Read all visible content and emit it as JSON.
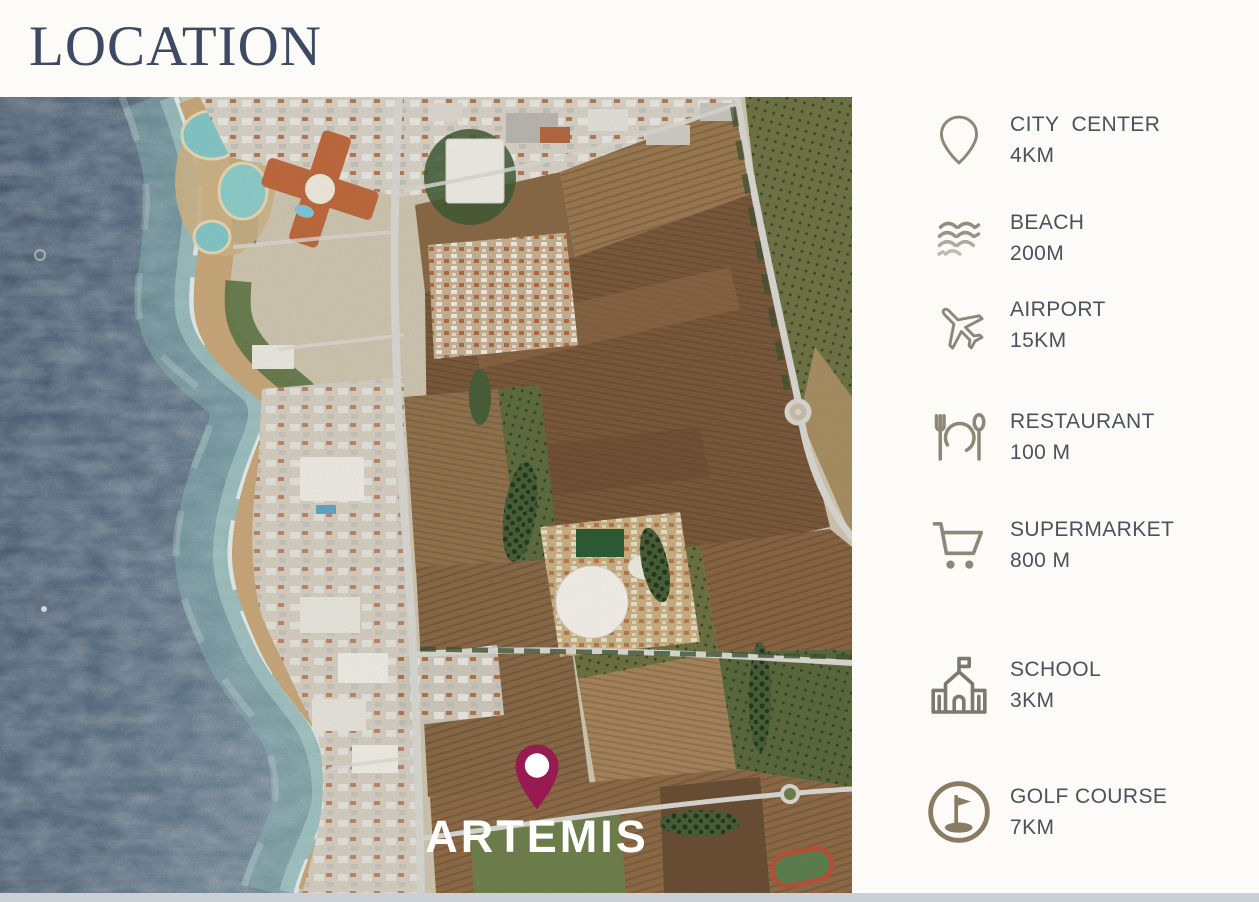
{
  "page": {
    "title": "LOCATION",
    "background": "#fcfbf7"
  },
  "map": {
    "project_label": "ARTEMIS",
    "pin_color": "#971b50",
    "type": "satellite-aerial-coastline"
  },
  "sidebar": {
    "items": [
      {
        "icon": "map-pin-icon",
        "label": "CITY  CENTER",
        "distance": "4KM"
      },
      {
        "icon": "waves-icon",
        "label": "BEACH",
        "distance": "200M"
      },
      {
        "icon": "airplane-icon",
        "label": "AIRPORT",
        "distance": "15KM"
      },
      {
        "icon": "restaurant-icon",
        "label": "RESTAURANT",
        "distance": "100 M"
      },
      {
        "icon": "shopping-cart-icon",
        "label": "SUPERMARKET",
        "distance": "800 M"
      },
      {
        "icon": "school-icon",
        "label": "SCHOOL",
        "distance": "3KM"
      },
      {
        "icon": "golf-icon",
        "label": "GOLF COURSE",
        "distance": "7KM"
      }
    ]
  },
  "colors": {
    "title": "#3d4a63",
    "sidebar_text": "#49525d",
    "icon": "#8e8678",
    "pin": "#971b50",
    "sea": "#5d7084",
    "sand": "#c9a87b",
    "bottom_strip": "#cbd0d6"
  }
}
